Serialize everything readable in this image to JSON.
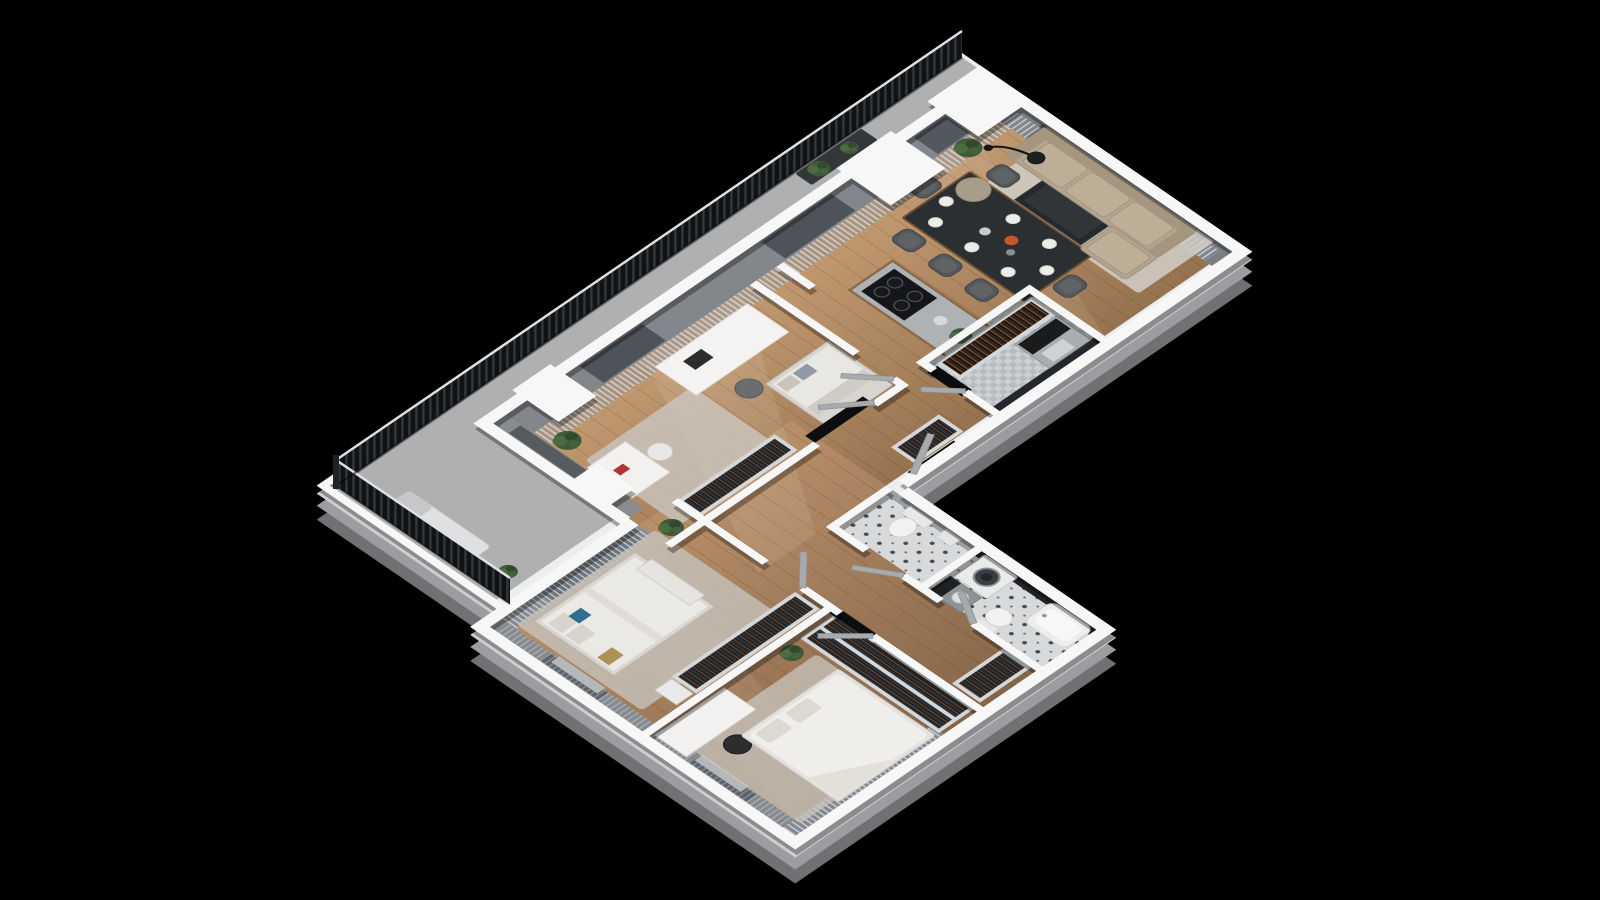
{
  "scene": {
    "title": "3D isometric floor plan of an apartment with balcony, viewed from above on a black background",
    "type": "3d-isometric-floor-plan",
    "background": "#000000"
  },
  "palette": {
    "background": "#000000",
    "wall_top_white": "#f7f7f8",
    "slab_light": "#babcbe",
    "slab_dark": "#85878a",
    "tall_wall_grey": "#83878c",
    "window_glass": "#4e535a",
    "dark_accent_wall": "#23262a",
    "floor_wood_light": "#c49b72",
    "floor_wood_dark": "#8a6a4b",
    "tile_light": "#d7d9da",
    "tile_pattern": "#454a51",
    "railing_dark": "#101214",
    "curtain_grey": "#d8dce0",
    "sofa_beige": "#b2a48e",
    "rug_light": "#d2cfc9",
    "table_dark": "#2c2f32",
    "wood_accent": "#6e5132",
    "chair_grey": "#54585b",
    "bedding_white": "#efede9",
    "pillow_blue": "#2f6e8e",
    "pillow_gold": "#ac9254",
    "plant_green": "#3f5a37",
    "appliance_white": "#e9eaea",
    "door_grey": "#a7abae"
  },
  "rooms": [
    {
      "name": "balcony",
      "floor": "concrete",
      "furniture": [
        "slatted railing",
        "sun lounger",
        "planter with greenery",
        "potted plant"
      ]
    },
    {
      "name": "study bedroom",
      "floor": "wood",
      "furniture": [
        "desk",
        "desk chair",
        "daybed with pillows",
        "vanity table",
        "stool",
        "wardrobe rack",
        "rug",
        "potted plant",
        "curtains"
      ]
    },
    {
      "name": "hallway",
      "floor": "wood",
      "furniture": [
        "wardrobe rack",
        "interior doors",
        "entrance door"
      ]
    },
    {
      "name": "kitchen",
      "floor": "wood",
      "furniture": [
        "island with cooktop",
        "4 burners",
        "potted plant",
        "bowl"
      ]
    },
    {
      "name": "dining area",
      "floor": "wood",
      "furniture": [
        "dining table",
        "8 chairs",
        "8 place settings",
        "vase",
        "serving dish"
      ]
    },
    {
      "name": "living room",
      "floor": "wood",
      "furniture": [
        "corner sofa",
        "glass coffee table",
        "pouf",
        "floor lamp",
        "area rug",
        "potted plant",
        "curtains"
      ]
    },
    {
      "name": "pantry",
      "floor": "tile",
      "furniture": [
        "wine rack",
        "cabinet with dark counter",
        "small appliance"
      ]
    },
    {
      "name": "bedroom 2",
      "floor": "wood",
      "furniture": [
        "double bed",
        "blue pillow",
        "gold pillow",
        "bench",
        "wardrobe rack",
        "dresser",
        "rug",
        "potted plant",
        "curtains"
      ]
    },
    {
      "name": "wc",
      "floor": "patterned tile",
      "furniture": [
        "wall-hung toilet",
        "small basin"
      ]
    },
    {
      "name": "bathroom laundry",
      "floor": "patterned tile",
      "furniture": [
        "washing machine",
        "sink cabinet",
        "toilet",
        "bathtub"
      ]
    },
    {
      "name": "master bedroom",
      "floor": "wood",
      "furniture": [
        "double bed with white duvet",
        "double wardrobe rack",
        "desk",
        "black chair",
        "rug",
        "potted plant",
        "curtains"
      ]
    }
  ],
  "counts": {
    "dining_chairs": 8,
    "cooktop_burners": 4,
    "wardrobe_racks": 5,
    "bathrooms": 2,
    "bedrooms": 3
  },
  "view": {
    "projection": "isometric",
    "rotation_deg": 34,
    "wall_style": "cutaway white-top walls"
  }
}
